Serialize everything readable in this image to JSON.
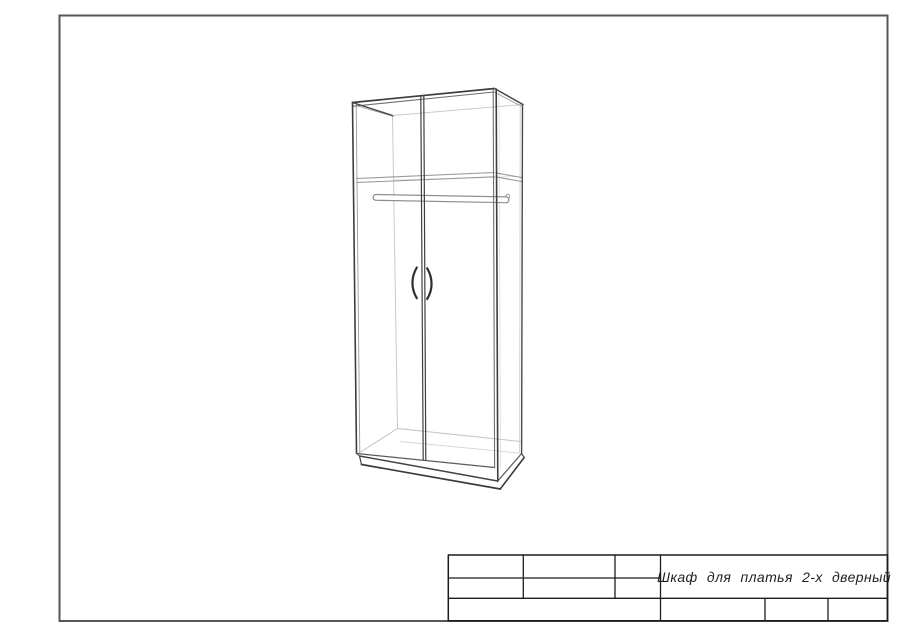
{
  "page": {
    "width": 900,
    "height": 636,
    "background": "#ffffff"
  },
  "frame": {
    "x": 59.5,
    "y": 15.5,
    "w": 828,
    "h": 605.5,
    "color": "#565656",
    "stroke_width": 2
  },
  "drawing": {
    "name": "2-door wardrobe perspective wireframe",
    "lines_back": [
      [
        392.5,
        115.5,
        522.5,
        104.5,
        "#c9c9c9",
        1
      ],
      [
        392.5,
        116,
        397.5,
        428.5,
        "#c9c9c9",
        1
      ],
      [
        397.5,
        428.5,
        520.5,
        441.5,
        "#c2c2c2",
        1
      ],
      [
        359,
        453,
        397.5,
        428.5,
        "#c2c2c2",
        1
      ],
      [
        400,
        441.5,
        521,
        453.2,
        "#d4d4d4",
        0.9
      ],
      [
        394,
        180,
        520,
        176.5,
        "#dadada",
        0.8
      ],
      [
        499,
        92.5,
        500.5,
        468,
        "#dcdcdc",
        0.8
      ],
      [
        520.2,
        106.5,
        519.6,
        452,
        "#d0d0d0",
        0.9
      ],
      [
        356.2,
        104.5,
        359.8,
        453,
        "#9a9a9a",
        0.9
      ],
      [
        356,
        105.5,
        393.5,
        116.5,
        "#a6a6a6",
        0.9
      ],
      [
        494,
        92,
        521,
        106,
        "#9a9a9a",
        0.9
      ],
      [
        356.5,
        178.5,
        494.5,
        172.5,
        "#999999",
        1.1
      ],
      [
        356.5,
        182.5,
        494.5,
        176.8,
        "#999999",
        1.1
      ],
      [
        497.5,
        173.2,
        521.5,
        177.5,
        "#999999",
        1.1
      ],
      [
        497.5,
        177.2,
        521.5,
        181.5,
        "#999999",
        1.1
      ]
    ],
    "rod": {
      "x1": 376,
      "y1": 197.4,
      "x2": 506,
      "y2": 199.8,
      "outer_color": "#8f8f8f",
      "outer_w": 7,
      "inner_color": "#ffffff",
      "inner_w": 4.6,
      "end_detail": {
        "d": "M 505 197 C 507 192.5 510.5 193.5 509 198.5",
        "color": "#9a9a9a",
        "w": 1
      }
    },
    "lines_front": [
      [
        352.5,
        102.5,
        494.5,
        88.5,
        "#3d3d3d",
        1.7
      ],
      [
        353.8,
        106.2,
        494,
        92,
        "#6f6f6f",
        1.1
      ],
      [
        352.5,
        102.5,
        392.5,
        115.5,
        "#474747",
        1.4
      ],
      [
        494.5,
        88.5,
        523,
        104.5,
        "#474747",
        1.5
      ],
      [
        352.5,
        102.5,
        356.5,
        453.5,
        "#3d3d3d",
        1.6
      ],
      [
        496.2,
        89,
        497.8,
        481.5,
        "#3d3d3d",
        1.6
      ],
      [
        493.2,
        89.5,
        494.6,
        467.5,
        "#6f6f6f",
        1.1
      ],
      [
        522.5,
        104.8,
        521.6,
        453.5,
        "#4a4a4a",
        1.4
      ],
      [
        356.5,
        453.5,
        494.5,
        467.5,
        "#5a5a5a",
        1.2
      ],
      [
        359.5,
        456,
        497.5,
        481,
        "#424242",
        1.4
      ],
      [
        361.5,
        464.5,
        500.2,
        489,
        "#3a3a3a",
        1.7
      ],
      [
        359.5,
        456,
        361.5,
        464.5,
        "#424242",
        1.2
      ],
      [
        356.5,
        453.5,
        359.5,
        456,
        "#555555",
        1
      ],
      [
        497.8,
        481,
        521.6,
        453.5,
        "#5a5a5a",
        1.2
      ],
      [
        500.2,
        489,
        524.2,
        457.5,
        "#3a3a3a",
        1.6
      ],
      [
        521.6,
        453.5,
        524.2,
        457.5,
        "#4a4a4a",
        1.2
      ],
      [
        420.8,
        95.8,
        423.2,
        459.8,
        "#3f3f3f",
        1.2
      ],
      [
        423.8,
        95.5,
        425.8,
        459.8,
        "#3f3f3f",
        1.2
      ]
    ],
    "handles": [
      {
        "d": "M 416.8 267.5 C 411.0 277.5 411.0 288.5 416.8 298.2",
        "color": "#2e2e2e",
        "w": 2.2
      },
      {
        "d": "M 427.2 268.3 C 433.0 278.3 433.0 289.3 427.2 299.0",
        "color": "#2e2e2e",
        "w": 2.2
      }
    ]
  },
  "title_block": {
    "title": "Шкаф для платья 2-х дверный",
    "text_color": "#1f1f1f",
    "line_color": "#1c1c1c",
    "lines": [
      [
        448.3,
        555,
        887.5,
        555,
        "#1c1c1c",
        1.5
      ],
      [
        448.3,
        620.8,
        887.5,
        620.8,
        "#1c1c1c",
        1.5
      ],
      [
        448.3,
        555,
        448.3,
        620.8,
        "#1c1c1c",
        1.5
      ],
      [
        887.5,
        555,
        887.5,
        620.8,
        "#1c1c1c",
        1.5
      ],
      [
        448.3,
        578,
        660.5,
        578,
        "#1c1c1c",
        1.3
      ],
      [
        448.3,
        598.3,
        887.5,
        598.3,
        "#1c1c1c",
        1.3
      ],
      [
        523.3,
        555,
        523.3,
        598.3,
        "#1c1c1c",
        1.3
      ],
      [
        615,
        555,
        615,
        598.3,
        "#1c1c1c",
        1.3
      ],
      [
        660.5,
        555,
        660.5,
        620.8,
        "#1c1c1c",
        1.3
      ],
      [
        765,
        598.3,
        765,
        620.8,
        "#1c1c1c",
        1.3
      ],
      [
        828,
        598.3,
        828,
        620.8,
        "#1c1c1c",
        1.3
      ]
    ]
  }
}
